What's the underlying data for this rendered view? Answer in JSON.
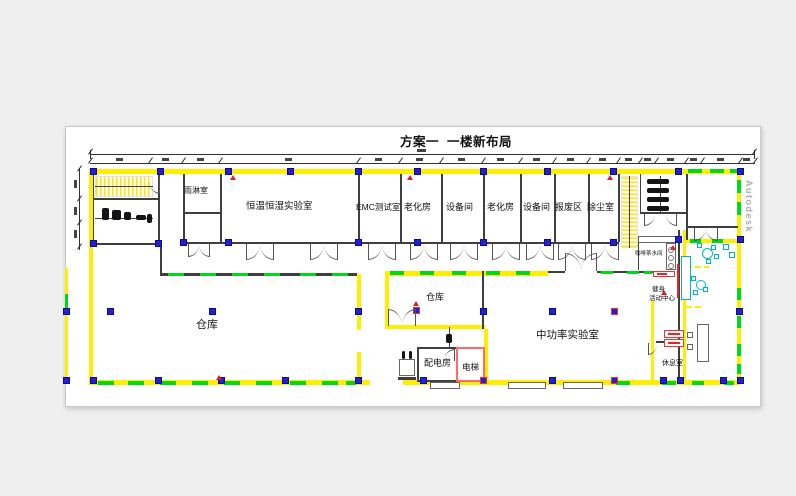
{
  "title": "方案一  一楼新布局",
  "watermark": "Autodesk",
  "rooms": {
    "rain_room": "雨淋室",
    "climate_lab": "恒温恒湿实验室",
    "emc_test": "EMC测试室",
    "aging_1": "老化房",
    "equipment_1": "设备间",
    "aging_2": "老化房",
    "equipment_2": "设备间",
    "scrap_area": "报废区",
    "dust_room": "除尘室",
    "warehouse_large": "仓库",
    "warehouse_small": "仓库",
    "power_dist_room": "配电房",
    "elevator": "电梯",
    "mid_power_lab": "中功率实验室",
    "coffee_room": "咖啡茶水间",
    "fitness_line1": "健身",
    "fitness_line2": "活动中心",
    "rest_room": "休息室"
  }
}
